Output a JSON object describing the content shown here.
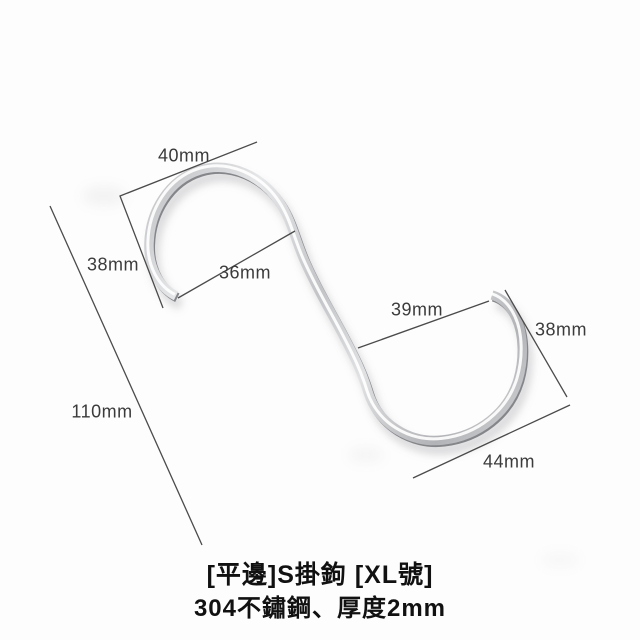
{
  "product": {
    "name": "[平邊]S掛鉤 [XL號]",
    "spec": "304不鏽鋼、厚度2mm"
  },
  "measurements": {
    "top_hook_width": "40mm",
    "top_hook_depth": "38mm",
    "top_hook_opening": "36mm",
    "overall_length": "110mm",
    "bottom_hook_opening": "39mm",
    "bottom_hook_depth": "38mm",
    "bottom_hook_width": "44mm"
  },
  "colors": {
    "background": "#fdfdfd",
    "metal_light": "#e6e7e9",
    "metal_mid": "#c3c4c7",
    "metal_dark": "#8d8e92",
    "dimension_line": "#4b4b4b",
    "label_text": "#3b3b3b",
    "caption_text": "#111111"
  }
}
